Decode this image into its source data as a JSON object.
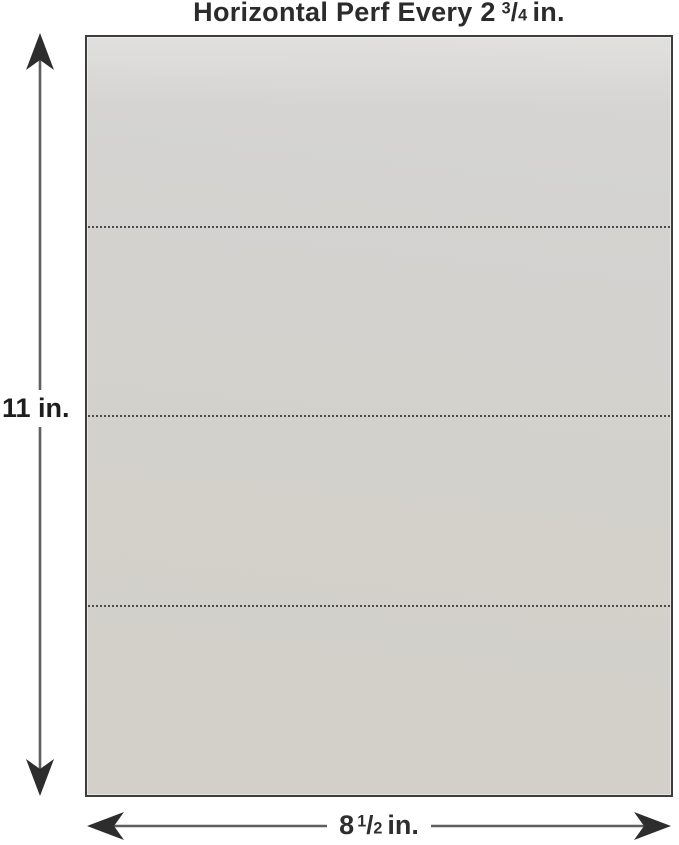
{
  "title": {
    "prefix": "Horizontal Perf Every 2",
    "fraction": {
      "numerator": "3",
      "slash": "/",
      "denominator": "4"
    },
    "suffix": "in."
  },
  "dimensions": {
    "height": {
      "label": "11 in."
    },
    "width": {
      "prefix": "8",
      "fraction": {
        "numerator": "1",
        "slash": "/",
        "denominator": "2"
      },
      "suffix": "in."
    }
  },
  "sheet": {
    "perforation_line_count": 3,
    "sections": 4
  },
  "colors": {
    "background": "#ffffff",
    "paper_fill": "#d3d1cb",
    "paper_border": "#3d3d3d",
    "perforation_dots": "#4b4b4b",
    "arrow_line": "#5f5f5f",
    "arrowhead": "#2d2d2d",
    "title_text": "#2b2b2b",
    "label_text": "#1e1e1e"
  }
}
